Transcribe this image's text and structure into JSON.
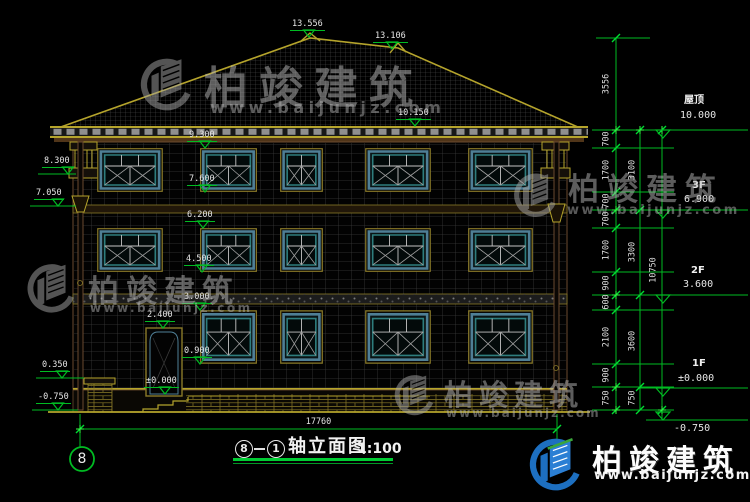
{
  "watermark": {
    "brand": "柏竣建筑",
    "url": "www.baijunjz.com"
  },
  "title": {
    "axis_start": "8",
    "axis_end": "1",
    "name": "轴立面图",
    "scale": "1:100"
  },
  "axis_bubble": "8",
  "dims": {
    "total_width": "17760",
    "right_inner": [
      "3556",
      "700",
      "1700",
      "700",
      "700",
      "1700",
      "900",
      "600",
      "2100",
      "900",
      "750"
    ],
    "right_mid": [
      "3100",
      "3300",
      "3600",
      "750"
    ],
    "right_total": "10750"
  },
  "levels": {
    "roof_label": "屋顶",
    "roof_value": "10.000",
    "f3_label": "3F",
    "f3_value": "6.900",
    "f2_label": "2F",
    "f2_value": "3.600",
    "f1_label": "1F",
    "f1_value": "±0.000",
    "grade_value": "-0.750"
  },
  "facade_marks": {
    "peak_main": "13.556",
    "peak_right": "13.106",
    "roof_edge": "10.150",
    "w3_top": "9.300",
    "w3_sill": "7.600",
    "w2_top": "6.200",
    "w2_sill": "4.500",
    "w1_top": "3.000",
    "door_top": "2.400",
    "w1_sill": "0.900",
    "floor_zero": "±0.000"
  },
  "left_marks": {
    "cornice": "8.300",
    "funnel": "7.050",
    "porch": "0.350",
    "grade": "-0.750"
  },
  "colors": {
    "dim_green": "#00bb22",
    "cad_yellow": "#b5a42c",
    "window_blue": "#4f7f96",
    "logo_blue": "#1d6fc0"
  }
}
